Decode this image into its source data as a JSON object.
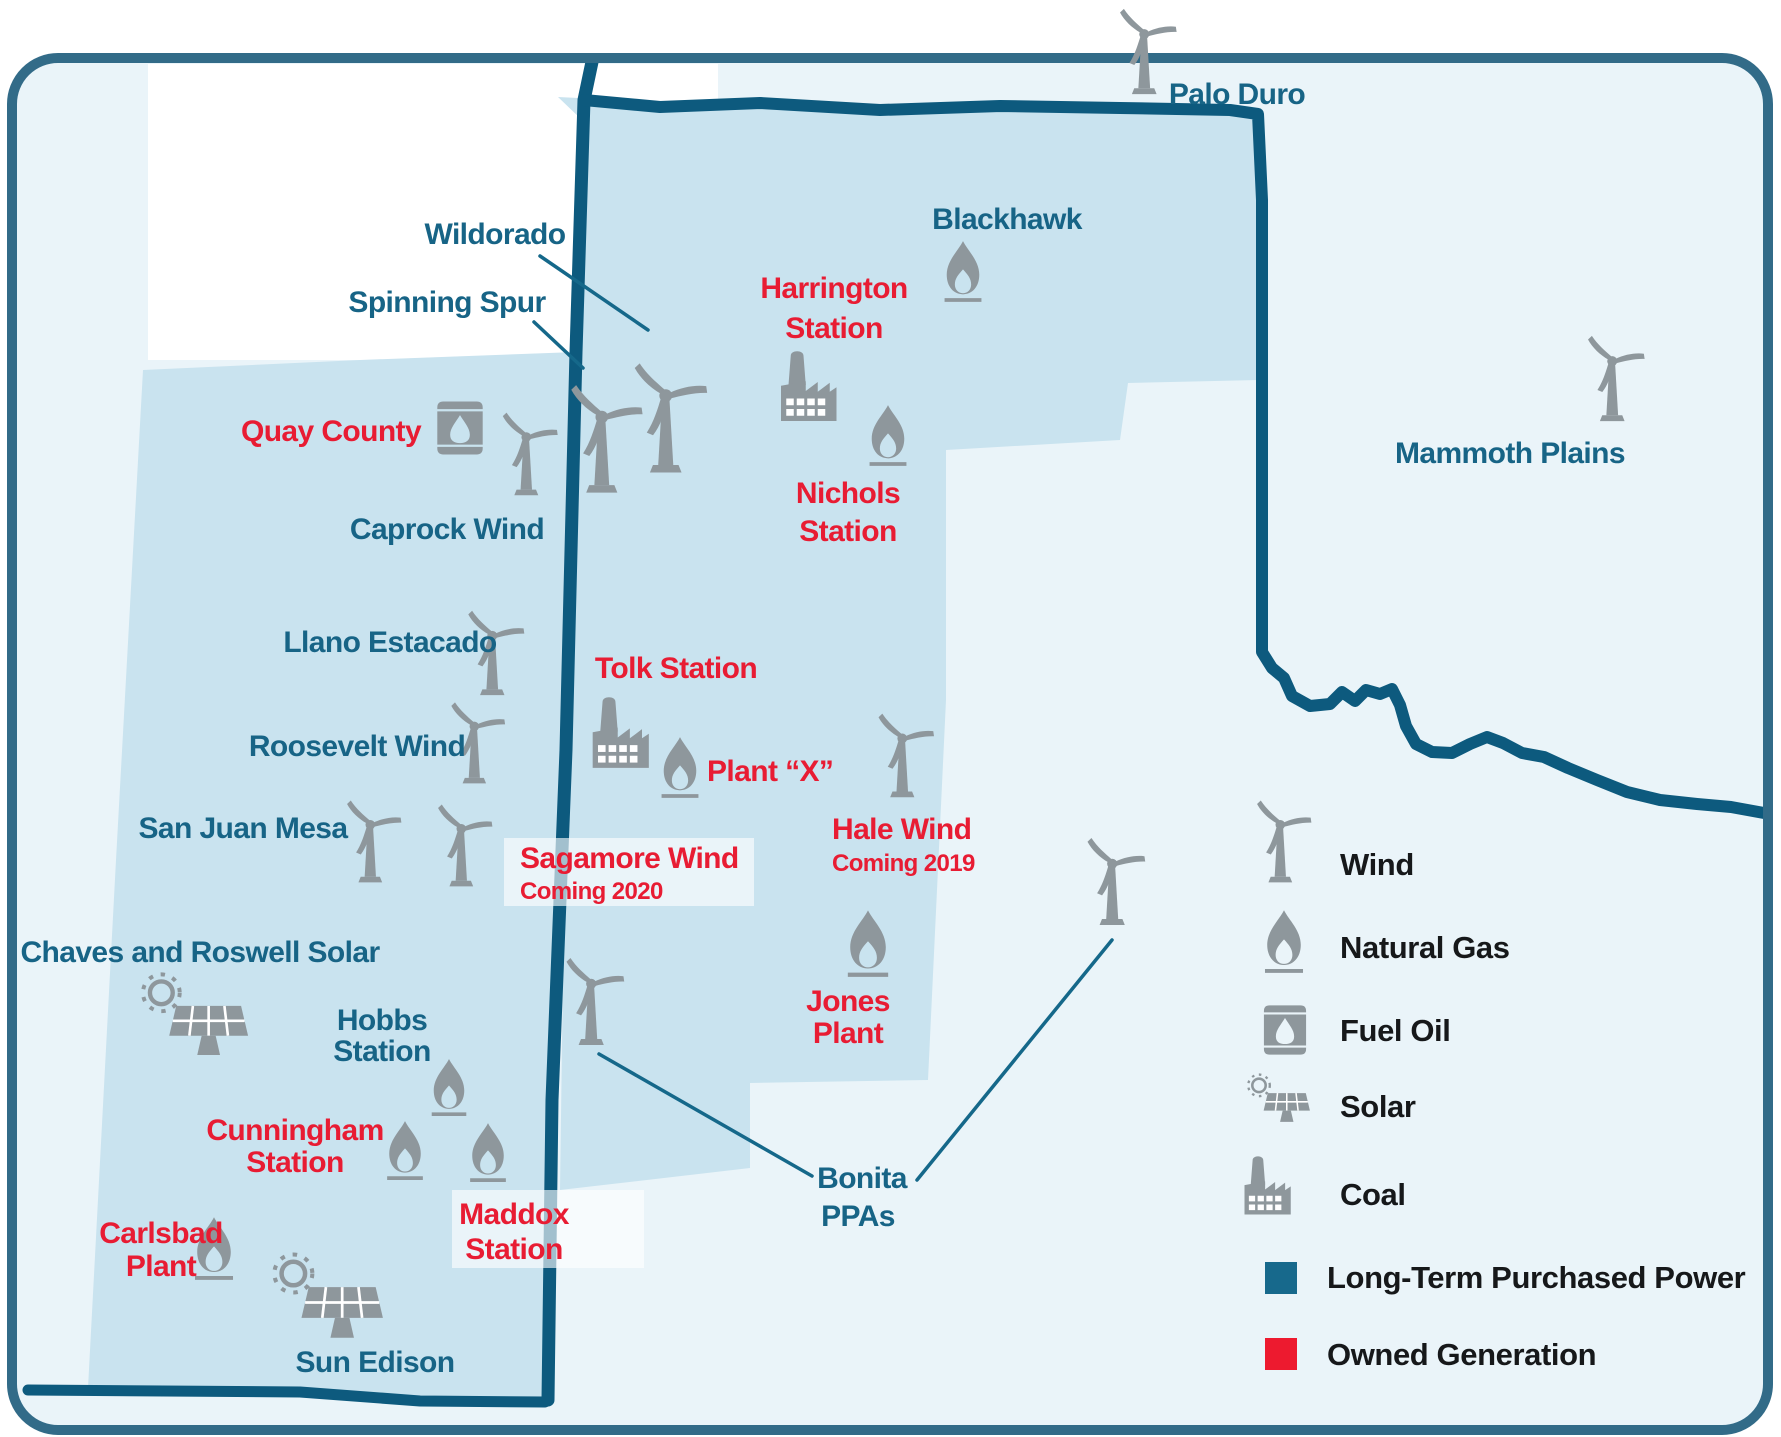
{
  "map": {
    "colors": {
      "page_bg": "#ffffff",
      "map_bg": "#eaf4f9",
      "territory_fill": "#c9e3ef",
      "border": "#0d5a7e",
      "outer_border": "#326b88",
      "teal_label": "#176486",
      "red_label": "#e81c33",
      "icon_gray": "#8e979c",
      "leader": "#15688a",
      "legend_text": "#16181a",
      "halo": "#ffffff"
    },
    "base": {
      "x": 12,
      "y": 58,
      "width": 1756,
      "height": 1372,
      "radius": 46,
      "outer_stroke_width": 10
    },
    "regions": [
      {
        "id": "new-mexico-territory",
        "points": "143,370 360,360 576,352 566,750 552,1100 548,1398 430,1400 300,1391 88,1388 116,860"
      },
      {
        "id": "texas-territory",
        "points": "558,97 700,104 900,109 1100,107 1258,113 1258,380 1128,383 1120,440 946,450 946,700 928,1080 750,1083 750,1168 560,1190 566,750 576,352 582,120"
      }
    ],
    "borders": [
      {
        "id": "nm-south-border",
        "width": 11,
        "points": "28,1390 300,1392 420,1401 545,1402"
      },
      {
        "id": "state-line",
        "width": 13,
        "points": "592,62 584,100 576,352 566,750 552,1100 548,1400"
      },
      {
        "id": "tx-border-and-river",
        "width": 12,
        "points": "584,100 660,107 760,103 880,110 1000,106 1120,108 1230,110 1258,114 1262,200 1262,380 1262,652 1272,668 1284,678 1292,696 1310,706 1330,704 1342,692 1355,701 1366,690 1380,694 1392,689 1400,705 1406,726 1416,744 1432,752 1452,753 1470,744 1487,737 1503,743 1522,753 1544,757 1568,768 1597,780 1627,792 1660,800 1697,804 1731,807 1764,813"
      }
    ],
    "halos": [
      {
        "id": "top-left-halo",
        "x": 148,
        "y": 64,
        "width": 570,
        "height": 296,
        "opacity": 1,
        "layer": "under"
      },
      {
        "id": "sagamore-halo",
        "x": 504,
        "y": 838,
        "width": 250,
        "height": 68,
        "opacity": 0.62,
        "layer": "over"
      },
      {
        "id": "maddox-halo",
        "x": 452,
        "y": 1190,
        "width": 192,
        "height": 78,
        "opacity": 0.62,
        "layer": "over"
      }
    ],
    "leader_lines": [
      {
        "id": "wildorado-leader",
        "x1": 540,
        "y1": 256,
        "x2": 648,
        "y2": 330
      },
      {
        "id": "spinning-spur-leader",
        "x1": 534,
        "y1": 322,
        "x2": 583,
        "y2": 368
      },
      {
        "id": "bonita-leader-west",
        "x1": 599,
        "y1": 1054,
        "x2": 812,
        "y2": 1176
      },
      {
        "id": "bonita-leader-east",
        "x1": 917,
        "y1": 1180,
        "x2": 1112,
        "y2": 940
      }
    ],
    "facilities": [
      {
        "id": "palo-duro",
        "color": "teal",
        "lines": [
          {
            "text": "Palo Duro",
            "x": 1237,
            "y": 104
          }
        ],
        "icons": [
          {
            "type": "wind",
            "cx": 1146,
            "bottom": 100,
            "h": 100
          }
        ]
      },
      {
        "id": "blackhawk",
        "color": "teal",
        "lines": [
          {
            "text": "Blackhawk",
            "x": 1007,
            "y": 229
          }
        ],
        "icons": [
          {
            "type": "gas",
            "cx": 963,
            "bottom": 303,
            "h": 64
          }
        ]
      },
      {
        "id": "wildorado",
        "color": "teal",
        "lines": [
          {
            "text": "Wildorado",
            "x": 495,
            "y": 244
          }
        ],
        "icons": [
          {
            "type": "wind",
            "cx": 668,
            "bottom": 480,
            "h": 128
          }
        ]
      },
      {
        "id": "spinning-spur",
        "color": "teal",
        "lines": [
          {
            "text": "Spinning Spur",
            "x": 447,
            "y": 312
          }
        ],
        "icons": [
          {
            "type": "wind",
            "cx": 604,
            "bottom": 500,
            "h": 126
          }
        ]
      },
      {
        "id": "harrington-station",
        "color": "red",
        "lines": [
          {
            "text": "Harrington",
            "x": 834,
            "y": 298
          },
          {
            "text": "Station",
            "x": 834,
            "y": 338
          }
        ],
        "icons": [
          {
            "type": "coal",
            "cx": 808,
            "bottom": 430,
            "h": 84
          }
        ]
      },
      {
        "id": "nichols-station",
        "color": "red",
        "lines": [
          {
            "text": "Nichols",
            "x": 848,
            "y": 503
          },
          {
            "text": "Station",
            "x": 848,
            "y": 541
          }
        ],
        "icons": [
          {
            "type": "gas",
            "cx": 888,
            "bottom": 467,
            "h": 64
          }
        ]
      },
      {
        "id": "quay-county",
        "color": "red",
        "lines": [
          {
            "text": "Quay County",
            "x": 331,
            "y": 441
          }
        ],
        "icons": [
          {
            "type": "oil",
            "cx": 460,
            "bottom": 456,
            "h": 56
          }
        ]
      },
      {
        "id": "caprock-wind",
        "color": "teal",
        "lines": [
          {
            "text": "Caprock Wind",
            "x": 447,
            "y": 539
          }
        ],
        "icons": [
          {
            "type": "wind",
            "cx": 528,
            "bottom": 501,
            "h": 97
          }
        ]
      },
      {
        "id": "mammoth-plains",
        "color": "teal",
        "lines": [
          {
            "text": "Mammoth Plains",
            "x": 1510,
            "y": 463
          }
        ],
        "icons": [
          {
            "type": "wind",
            "cx": 1614,
            "bottom": 427,
            "h": 100
          }
        ]
      },
      {
        "id": "llano-estacado",
        "color": "teal",
        "lines": [
          {
            "text": "Llano Estacado",
            "x": 390,
            "y": 652
          }
        ],
        "icons": [
          {
            "type": "wind",
            "cx": 494,
            "bottom": 701,
            "h": 99
          }
        ]
      },
      {
        "id": "tolk-station",
        "color": "red",
        "lines": [
          {
            "text": "Tolk Station",
            "x": 676,
            "y": 678
          }
        ],
        "icons": [
          {
            "type": "coal",
            "cx": 620,
            "bottom": 777,
            "h": 85
          }
        ]
      },
      {
        "id": "roosevelt-wind",
        "color": "teal",
        "lines": [
          {
            "text": "Roosevelt Wind",
            "x": 357,
            "y": 756
          }
        ],
        "icons": [
          {
            "type": "wind",
            "cx": 476,
            "bottom": 789,
            "h": 95
          }
        ]
      },
      {
        "id": "plant-x",
        "color": "red",
        "align": "start",
        "lines": [
          {
            "text": "Plant “X”",
            "x": 707,
            "y": 781
          }
        ],
        "icons": [
          {
            "type": "gas",
            "cx": 680,
            "bottom": 799,
            "h": 64
          }
        ]
      },
      {
        "id": "hale-wind",
        "color": "red",
        "align": "start",
        "lines": [
          {
            "text": "Hale Wind",
            "x": 832,
            "y": 839
          },
          {
            "text": "Coming 2019",
            "x": 832,
            "y": 871,
            "size": 24
          }
        ],
        "icons": [
          {
            "type": "wind",
            "cx": 904,
            "bottom": 803,
            "h": 98
          }
        ]
      },
      {
        "id": "san-juan-mesa",
        "color": "teal",
        "lines": [
          {
            "text": "San Juan Mesa",
            "x": 243,
            "y": 838
          }
        ],
        "icons": [
          {
            "type": "wind",
            "cx": 372,
            "bottom": 888,
            "h": 96
          }
        ]
      },
      {
        "id": "sagamore-wind",
        "color": "red",
        "align": "start",
        "lines": [
          {
            "text": "Sagamore Wind",
            "x": 520,
            "y": 868
          },
          {
            "text": "Coming 2020",
            "x": 520,
            "y": 899,
            "size": 24
          }
        ],
        "icons": [
          {
            "type": "wind",
            "cx": 463,
            "bottom": 892,
            "h": 96
          }
        ]
      },
      {
        "id": "chaves-and-roswell-solar",
        "color": "teal",
        "lines": [
          {
            "text": "Chaves and Roswell Solar",
            "x": 200,
            "y": 962
          }
        ],
        "icons": [
          {
            "type": "solar",
            "cx": 192,
            "bottom": 1062,
            "h": 92
          }
        ]
      },
      {
        "id": "hobbs-station",
        "color": "teal",
        "lines": [
          {
            "text": "Hobbs",
            "x": 382,
            "y": 1030
          },
          {
            "text": "Station",
            "x": 382,
            "y": 1061
          }
        ],
        "icons": [
          {
            "type": "gas",
            "cx": 449,
            "bottom": 1117,
            "h": 60
          }
        ]
      },
      {
        "id": "jones-plant",
        "color": "red",
        "lines": [
          {
            "text": "Jones",
            "x": 848,
            "y": 1011
          },
          {
            "text": "Plant",
            "x": 848,
            "y": 1043
          }
        ],
        "icons": [
          {
            "type": "gas",
            "cx": 868,
            "bottom": 978,
            "h": 70
          }
        ]
      },
      {
        "id": "bonita-ppas",
        "color": "teal",
        "lines": [
          {
            "text": "Bonita",
            "x": 862,
            "y": 1188
          },
          {
            "text": "PPAs",
            "x": 858,
            "y": 1226
          }
        ],
        "icons": [
          {
            "type": "wind",
            "cx": 593,
            "bottom": 1051,
            "h": 102
          },
          {
            "type": "wind",
            "cx": 1114,
            "bottom": 931,
            "h": 102
          }
        ]
      },
      {
        "id": "cunningham-station",
        "color": "red",
        "lines": [
          {
            "text": "Cunningham",
            "x": 295,
            "y": 1140
          },
          {
            "text": "Station",
            "x": 295,
            "y": 1172
          }
        ],
        "icons": [
          {
            "type": "gas",
            "cx": 405,
            "bottom": 1181,
            "h": 62
          }
        ]
      },
      {
        "id": "maddox-station",
        "color": "red",
        "lines": [
          {
            "text": "Maddox",
            "x": 514,
            "y": 1224
          },
          {
            "text": "Station",
            "x": 514,
            "y": 1259
          }
        ],
        "icons": [
          {
            "type": "gas",
            "cx": 488,
            "bottom": 1183,
            "h": 62
          }
        ]
      },
      {
        "id": "carlsbad-plant",
        "color": "red",
        "lines": [
          {
            "text": "Carlsbad",
            "x": 161,
            "y": 1243
          },
          {
            "text": "Plant",
            "x": 161,
            "y": 1276
          }
        ],
        "icons": [
          {
            "type": "gas",
            "cx": 214,
            "bottom": 1281,
            "h": 66
          }
        ]
      },
      {
        "id": "sun-edison",
        "color": "teal",
        "lines": [
          {
            "text": "Sun Edison",
            "x": 375,
            "y": 1372
          }
        ],
        "icons": [
          {
            "type": "solar",
            "cx": 325,
            "bottom": 1345,
            "h": 95
          }
        ]
      }
    ]
  },
  "legend": {
    "items": [
      {
        "id": "wind",
        "kind": "icon",
        "icon": "wind",
        "label": "Wind",
        "icon_cx": 1282,
        "icon_bottom": 888,
        "icon_h": 96,
        "text_x": 1340,
        "text_y": 875
      },
      {
        "id": "natural-gas",
        "kind": "icon",
        "icon": "gas",
        "label": "Natural Gas",
        "icon_cx": 1284,
        "icon_bottom": 974,
        "icon_h": 66,
        "text_x": 1340,
        "text_y": 958
      },
      {
        "id": "fuel-oil",
        "kind": "icon",
        "icon": "oil",
        "label": "Fuel Oil",
        "icon_cx": 1285,
        "icon_bottom": 1056,
        "icon_h": 52,
        "text_x": 1340,
        "text_y": 1041
      },
      {
        "id": "solar",
        "kind": "icon",
        "icon": "solar",
        "label": "Solar",
        "icon_cx": 1277,
        "icon_bottom": 1126,
        "icon_h": 54,
        "text_x": 1340,
        "text_y": 1117
      },
      {
        "id": "coal",
        "kind": "icon",
        "icon": "coal",
        "label": "Coal",
        "icon_cx": 1267,
        "icon_bottom": 1222,
        "icon_h": 70,
        "text_x": 1340,
        "text_y": 1205
      },
      {
        "id": "long-term-purchased-power",
        "kind": "swatch",
        "swatch": "#17698c",
        "label": "Long-Term Purchased Power",
        "swatch_x": 1265,
        "swatch_y": 1262,
        "swatch_size": 32,
        "text_x": 1327,
        "text_y": 1288
      },
      {
        "id": "owned-generation",
        "kind": "swatch",
        "swatch": "#ed1a2f",
        "label": "Owned Generation",
        "swatch_x": 1265,
        "swatch_y": 1338,
        "swatch_size": 32,
        "text_x": 1327,
        "text_y": 1365
      }
    ]
  }
}
